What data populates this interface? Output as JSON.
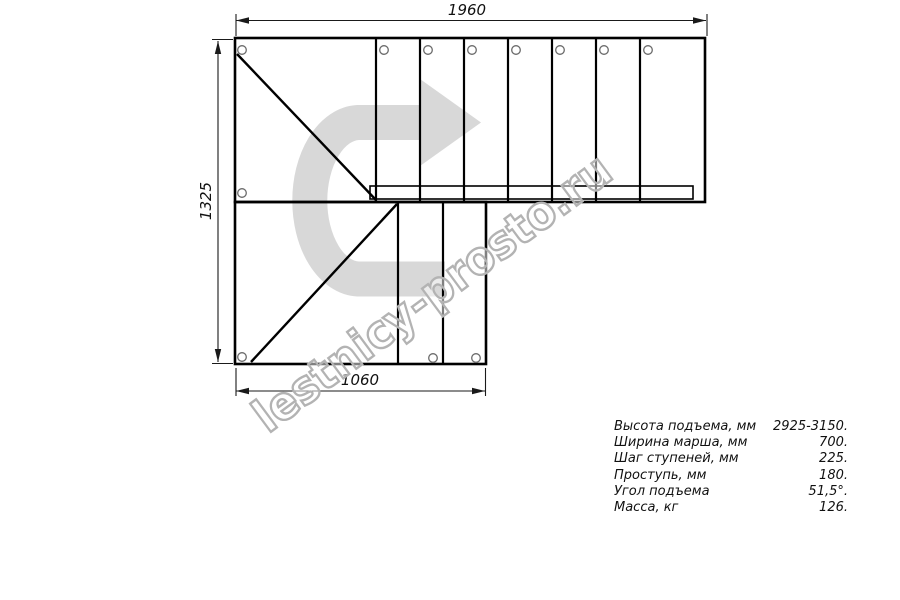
{
  "drawing": {
    "type": "staircase-plan-top-view",
    "dim_top": {
      "label": "1960"
    },
    "dim_left": {
      "label": "1325"
    },
    "dim_bottom": {
      "label": "1060"
    },
    "icons": {
      "direction": "u-turn-right-arrow"
    },
    "colors": {
      "line": "#000000",
      "dimension_text": "#111111",
      "arrow_fill": "#d8d8d8",
      "hole_stroke": "#6a6a6a",
      "watermark_stroke": "#b3b3b3"
    }
  },
  "watermark": {
    "text": "lestnicy-prosto.ru"
  },
  "specs": {
    "rows": [
      {
        "label": "Высота подъема, мм",
        "value": "2925-3150."
      },
      {
        "label": "Ширина марша, мм",
        "value": "700."
      },
      {
        "label": "Шаг ступеней, мм",
        "value": "225."
      },
      {
        "label": "Проступь, мм",
        "value": "180."
      },
      {
        "label": "Угол подъема",
        "value": "51,5°."
      },
      {
        "label": "Масса, кг",
        "value": "126."
      }
    ]
  }
}
